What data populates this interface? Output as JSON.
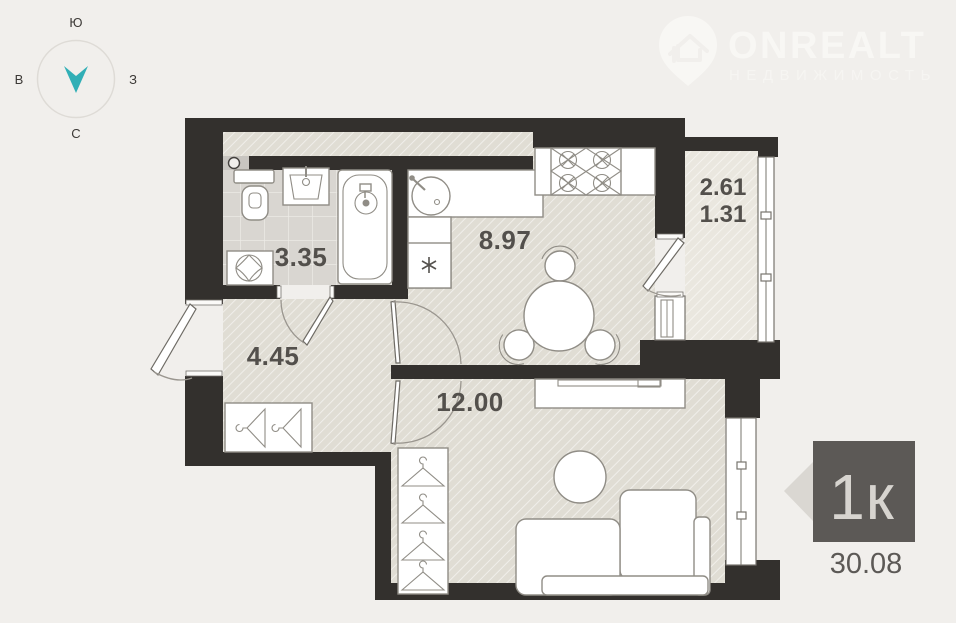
{
  "compass": {
    "top": "Ю",
    "left": "В",
    "right": "З",
    "bottom": "С"
  },
  "watermark": {
    "brand": "ONREALT",
    "tagline": "НЕДВИЖИМОСТЬ"
  },
  "plan": {
    "rooms": {
      "bathroom": {
        "area": "3.35"
      },
      "kitchen": {
        "area": "8.97"
      },
      "balcony": {
        "area_total": "2.61",
        "area_counted": "1.31"
      },
      "hallway": {
        "area": "4.45"
      },
      "living_room": {
        "area": "12.00"
      }
    }
  },
  "listing": {
    "rooms_badge": "1к",
    "total_area": "30.08"
  },
  "colors": {
    "background": "#f1efec",
    "wall": "#33302d",
    "floor": "#e0ddd4",
    "balcony_floor": "#eae7df",
    "tile_floor": "#d9d6d1",
    "accent_teal": "#31afb6",
    "badge_bg": "#5c5956",
    "badge_text": "#d7d4cf"
  }
}
